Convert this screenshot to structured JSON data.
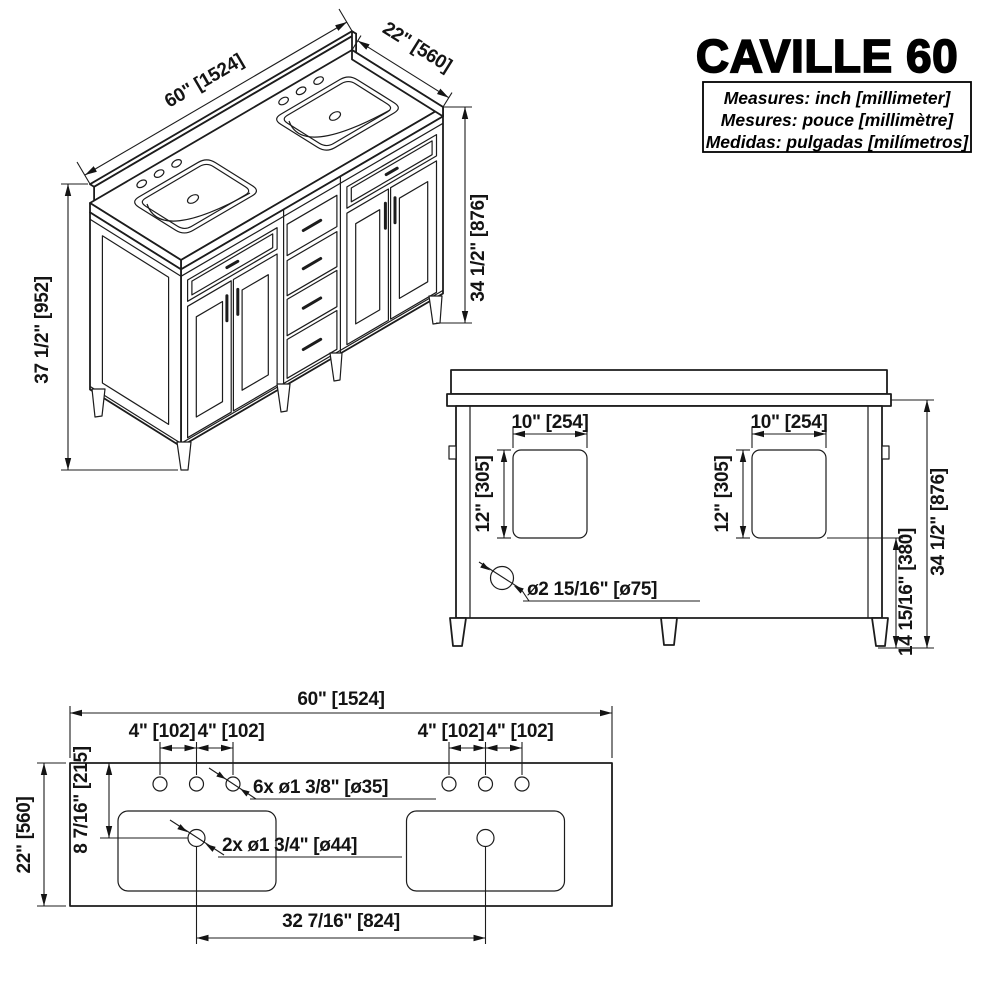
{
  "title": "CAVILLE 60",
  "legend": {
    "en": "Measures: inch [millimeter]",
    "fr": "Mesures: pouce [millimètre]",
    "es": "Medidas: pulgadas [milímetros]"
  },
  "iso_view": {
    "width": "60\" [1524]",
    "depth": "22\" [560]",
    "total_height": "37 1/2\" [952]",
    "counter_height": "34 1/2\" [876]"
  },
  "rear_view": {
    "cutout_width_left": "10\" [254]",
    "cutout_width_right": "10\" [254]",
    "cutout_height_left": "12\" [305]",
    "cutout_height_right": "12\" [305]",
    "drain_hole": "ø2 15/16\" [ø75]",
    "floor_to_cutout": "14 15/16\" [380]",
    "height": "34 1/2\" [876]"
  },
  "plan_view": {
    "width": "60\" [1524]",
    "depth": "22\" [560]",
    "back_to_drain": "8 7/16\" [215]",
    "spacing": [
      "4\" [102]",
      "4\" [102]",
      "4\" [102]",
      "4\" [102]"
    ],
    "faucet_holes": "6x ø1 3/8\" [ø35]",
    "drain_holes": "2x ø1 3/4\" [ø44]",
    "drain_spacing": "32 7/16\" [824]"
  }
}
